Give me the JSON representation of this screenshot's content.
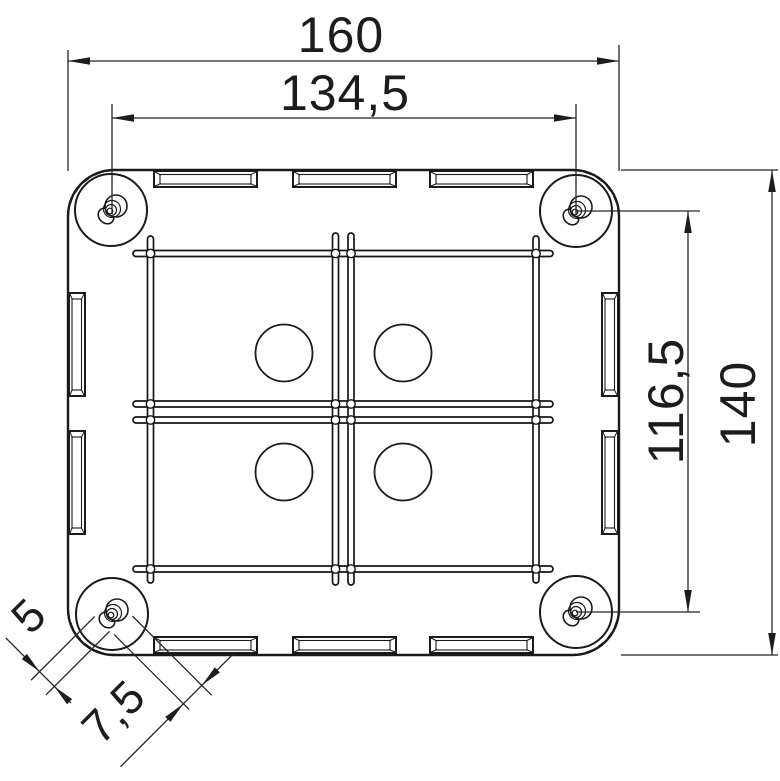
{
  "drawing": {
    "type": "technical_drawing",
    "subject": "junction-box-top-view",
    "background_color": "#ffffff",
    "line_color": "#1a1a1a",
    "dimensions": {
      "overall_width": {
        "value": "160",
        "orientation": "horizontal"
      },
      "screw_spacing_horizontal": {
        "value": "134,5",
        "orientation": "horizontal"
      },
      "overall_height": {
        "value": "140",
        "orientation": "vertical"
      },
      "screw_spacing_vertical": {
        "value": "116,5",
        "orientation": "vertical"
      },
      "screw_thread_diameter": {
        "value": "5",
        "orientation": "oblique-45"
      },
      "screw_head_diameter": {
        "value": "7,5",
        "orientation": "oblique-45"
      }
    }
  }
}
